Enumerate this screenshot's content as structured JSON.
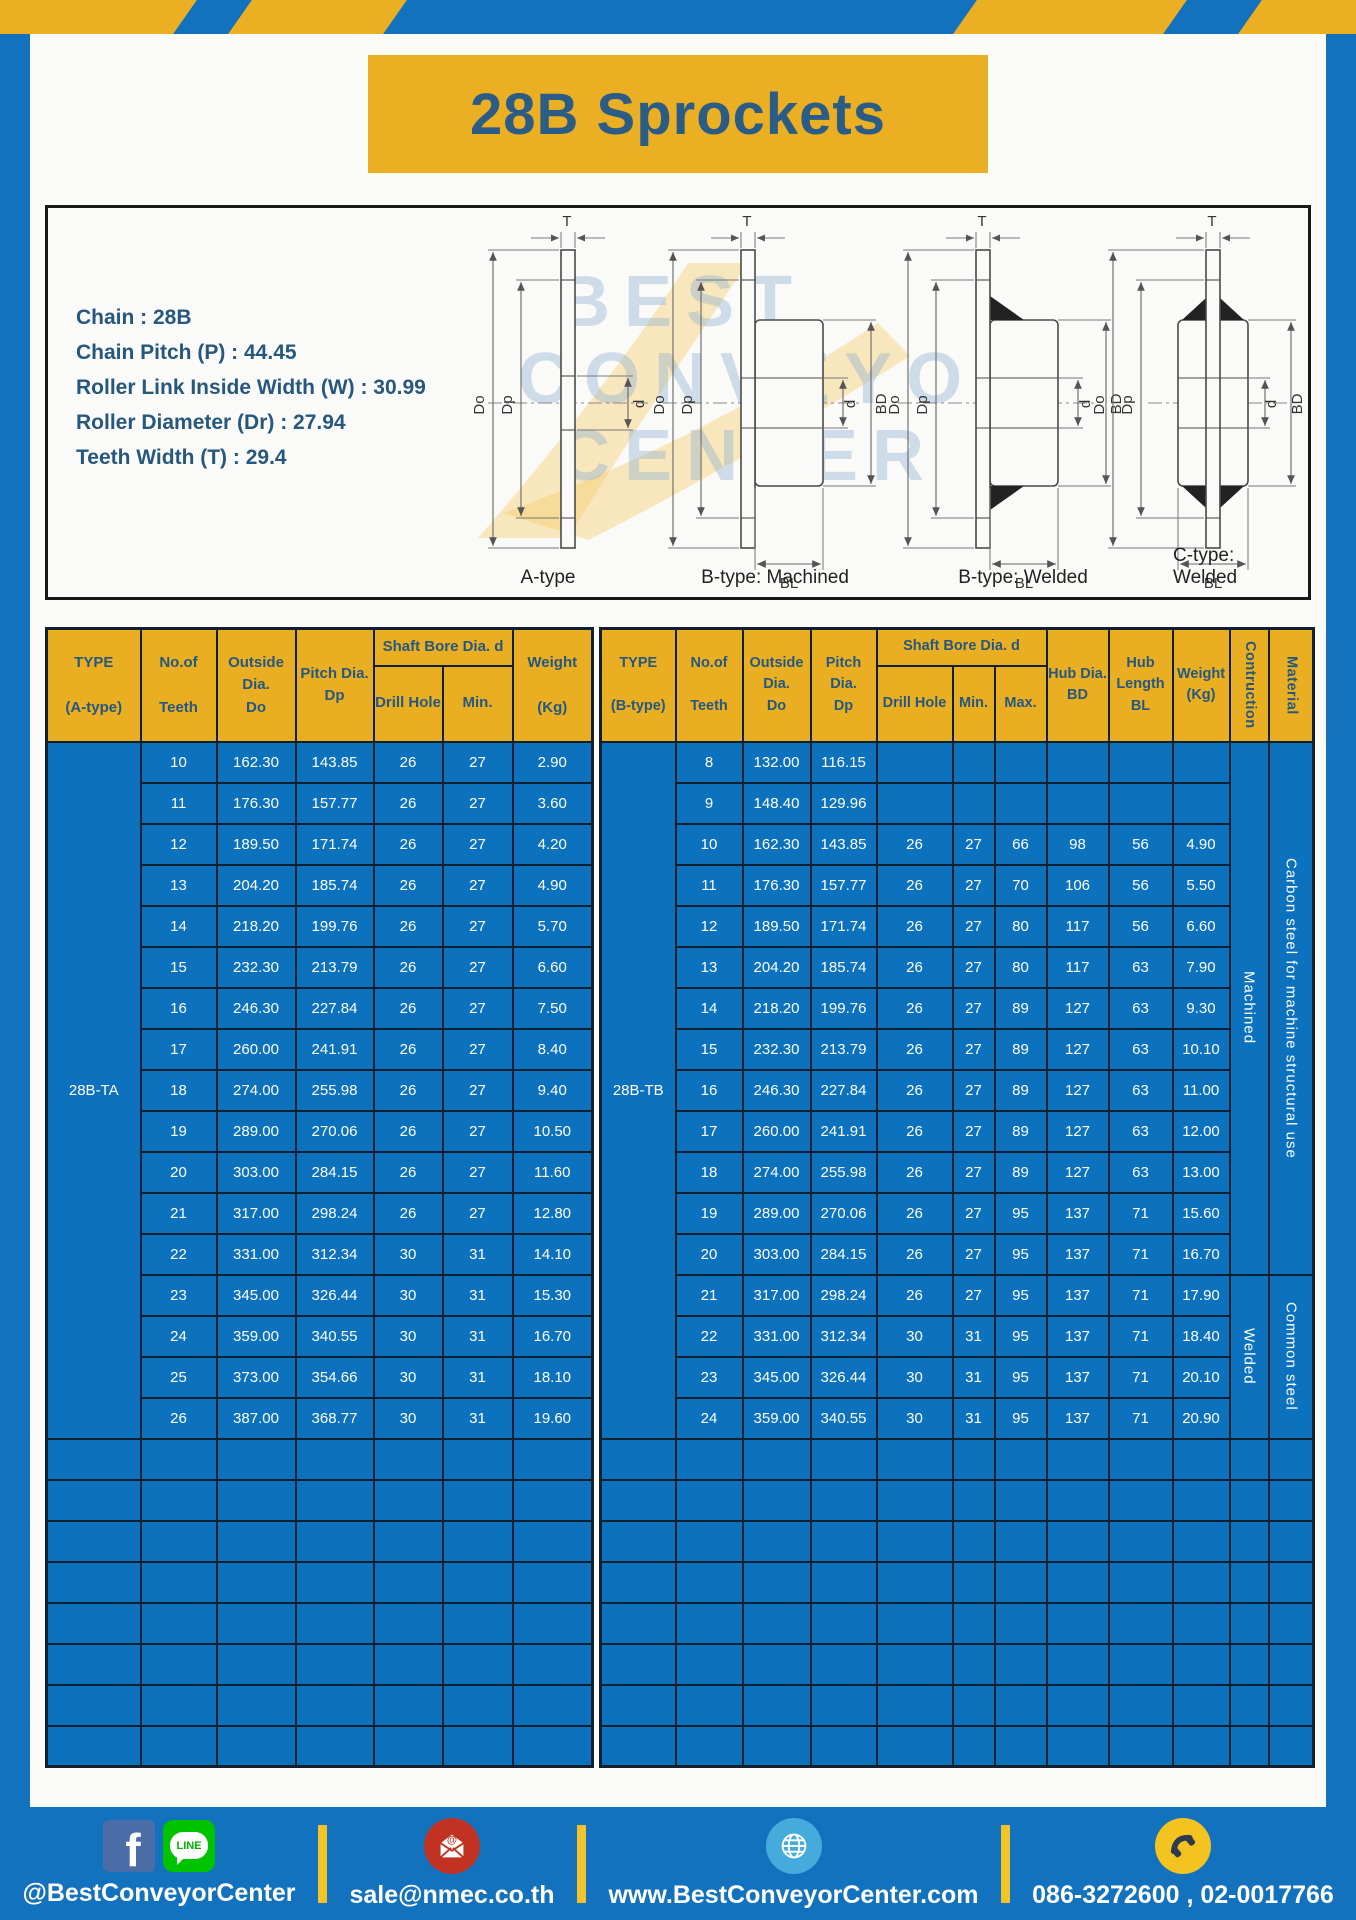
{
  "title": "28B Sprockets",
  "specs": [
    "Chain : 28B",
    "Chain Pitch (P) : 44.45",
    "Roller Link Inside Width (W) : 30.99",
    "Roller Diameter (Dr) : 27.94",
    "Teeth Width (T) : 29.4"
  ],
  "diagram": {
    "captions": [
      "A-type",
      "B-type: Machined",
      "B-type: Welded",
      "C-type: Welded"
    ],
    "dims": {
      "t": "T",
      "do": "Do",
      "dp": "Dp",
      "d": "d",
      "bd": "BD",
      "bl": "BL"
    },
    "watermark": [
      "BEST",
      "CONVEYOR",
      "CENTER"
    ]
  },
  "table_a": {
    "type_label": "28B-TA",
    "headers": {
      "type": "TYPE\n\n(A-type)",
      "teeth": "No.of\n\nTeeth",
      "outside": "Outside\nDia.\nDo",
      "pitch": "Pitch Dia.\nDp",
      "shaft_bore": "Shaft Bore Dia. d",
      "drill": "Drill Hole",
      "min": "Min.",
      "weight": "Weight\n\n(Kg)"
    },
    "rows": [
      [
        "10",
        "162.30",
        "143.85",
        "26",
        "27",
        "2.90"
      ],
      [
        "11",
        "176.30",
        "157.77",
        "26",
        "27",
        "3.60"
      ],
      [
        "12",
        "189.50",
        "171.74",
        "26",
        "27",
        "4.20"
      ],
      [
        "13",
        "204.20",
        "185.74",
        "26",
        "27",
        "4.90"
      ],
      [
        "14",
        "218.20",
        "199.76",
        "26",
        "27",
        "5.70"
      ],
      [
        "15",
        "232.30",
        "213.79",
        "26",
        "27",
        "6.60"
      ],
      [
        "16",
        "246.30",
        "227.84",
        "26",
        "27",
        "7.50"
      ],
      [
        "17",
        "260.00",
        "241.91",
        "26",
        "27",
        "8.40"
      ],
      [
        "18",
        "274.00",
        "255.98",
        "26",
        "27",
        "9.40"
      ],
      [
        "19",
        "289.00",
        "270.06",
        "26",
        "27",
        "10.50"
      ],
      [
        "20",
        "303.00",
        "284.15",
        "26",
        "27",
        "11.60"
      ],
      [
        "21",
        "317.00",
        "298.24",
        "26",
        "27",
        "12.80"
      ],
      [
        "22",
        "331.00",
        "312.34",
        "30",
        "31",
        "14.10"
      ],
      [
        "23",
        "345.00",
        "326.44",
        "30",
        "31",
        "15.30"
      ],
      [
        "24",
        "359.00",
        "340.55",
        "30",
        "31",
        "16.70"
      ],
      [
        "25",
        "373.00",
        "354.66",
        "30",
        "31",
        "18.10"
      ],
      [
        "26",
        "387.00",
        "368.77",
        "30",
        "31",
        "19.60"
      ]
    ],
    "empty_row_count": 8
  },
  "table_b": {
    "type_label": "28B-TB",
    "headers": {
      "type": "TYPE\n\n(B-type)",
      "teeth": "No.of\n\nTeeth",
      "outside": "Outside\nDia.\nDo",
      "pitch": "Pitch Dia.\nDp",
      "shaft_bore": "Shaft Bore Dia. d",
      "drill": "Drill Hole",
      "min": "Min.",
      "max": "Max.",
      "hub_dia": "Hub Dia.\nBD",
      "hub_len": "Hub\nLength\nBL",
      "weight": "Weight\n(Kg)",
      "construction": "Contruction",
      "material": "Material"
    },
    "rows": [
      [
        "8",
        "132.00",
        "116.15",
        "",
        "",
        "",
        "",
        "",
        ""
      ],
      [
        "9",
        "148.40",
        "129.96",
        "",
        "",
        "",
        "",
        "",
        ""
      ],
      [
        "10",
        "162.30",
        "143.85",
        "26",
        "27",
        "66",
        "98",
        "56",
        "4.90"
      ],
      [
        "11",
        "176.30",
        "157.77",
        "26",
        "27",
        "70",
        "106",
        "56",
        "5.50"
      ],
      [
        "12",
        "189.50",
        "171.74",
        "26",
        "27",
        "80",
        "117",
        "56",
        "6.60"
      ],
      [
        "13",
        "204.20",
        "185.74",
        "26",
        "27",
        "80",
        "117",
        "63",
        "7.90"
      ],
      [
        "14",
        "218.20",
        "199.76",
        "26",
        "27",
        "89",
        "127",
        "63",
        "9.30"
      ],
      [
        "15",
        "232.30",
        "213.79",
        "26",
        "27",
        "89",
        "127",
        "63",
        "10.10"
      ],
      [
        "16",
        "246.30",
        "227.84",
        "26",
        "27",
        "89",
        "127",
        "63",
        "11.00"
      ],
      [
        "17",
        "260.00",
        "241.91",
        "26",
        "27",
        "89",
        "127",
        "63",
        "12.00"
      ],
      [
        "18",
        "274.00",
        "255.98",
        "26",
        "27",
        "89",
        "127",
        "63",
        "13.00"
      ],
      [
        "19",
        "289.00",
        "270.06",
        "26",
        "27",
        "95",
        "137",
        "71",
        "15.60"
      ],
      [
        "20",
        "303.00",
        "284.15",
        "26",
        "27",
        "95",
        "137",
        "71",
        "16.70"
      ],
      [
        "21",
        "317.00",
        "298.24",
        "26",
        "27",
        "95",
        "137",
        "71",
        "17.90"
      ],
      [
        "22",
        "331.00",
        "312.34",
        "30",
        "31",
        "95",
        "137",
        "71",
        "18.40"
      ],
      [
        "23",
        "345.00",
        "326.44",
        "30",
        "31",
        "95",
        "137",
        "71",
        "20.10"
      ],
      [
        "24",
        "359.00",
        "340.55",
        "30",
        "31",
        "95",
        "137",
        "71",
        "20.90"
      ]
    ],
    "row_groups": {
      "construction": [
        {
          "label": "Machined",
          "rows": 13
        },
        {
          "label": "Welded",
          "rows": 4
        }
      ],
      "material": [
        {
          "label": "Carbon steel for machine structural use",
          "rows": 13
        },
        {
          "label": "Common steel",
          "rows": 4
        }
      ]
    },
    "empty_row_count": 8
  },
  "footer": {
    "groups": [
      {
        "text": "@BestConveyorCenter"
      },
      {
        "text": "sale@nmec.co.th"
      },
      {
        "text": "www.BestConveyorCenter.com"
      },
      {
        "text": "086-3272600 , 02-0017766"
      }
    ],
    "line_label": "LINE"
  },
  "colors": {
    "frame_blue": "#1372BD",
    "table_blue": "#0D72BE",
    "header_yellow": "#EAAE23",
    "dark_text": "#26587E",
    "border_dark": "#10202E",
    "footer_separator_yellow": "#F2C428"
  }
}
